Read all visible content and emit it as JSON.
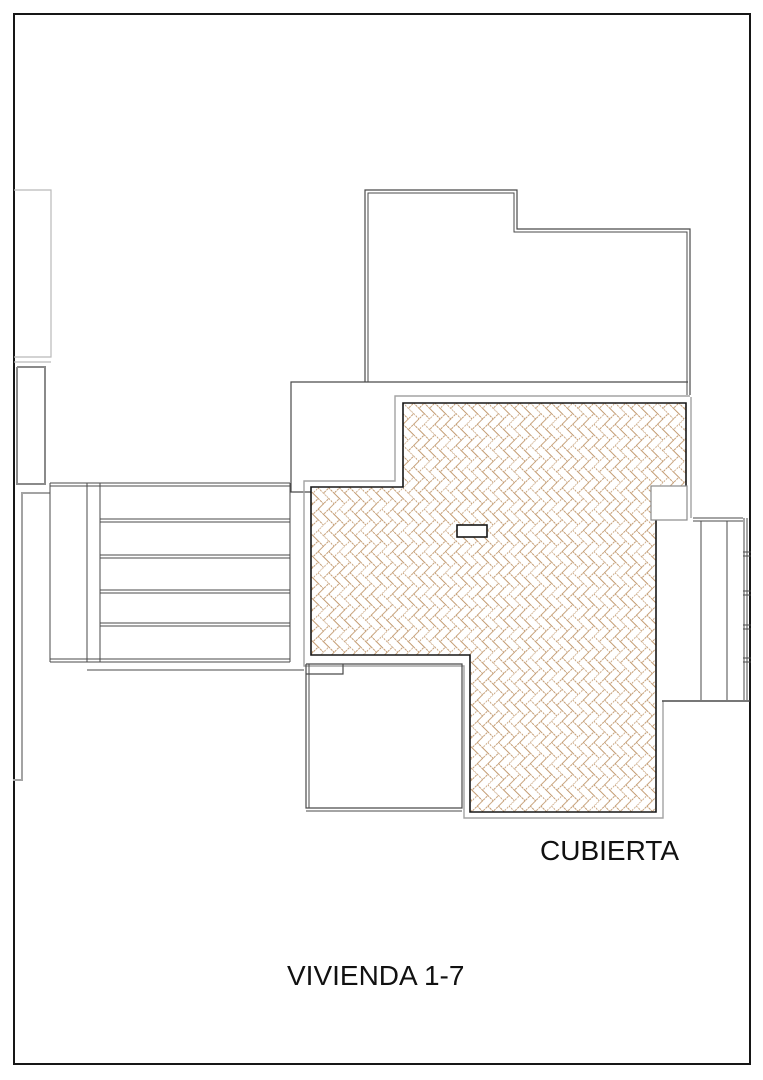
{
  "plan": {
    "labels": {
      "roof": {
        "text": "CUBIERTA",
        "x": 540,
        "y": 860,
        "size": 28
      },
      "unit": {
        "text": "VIVIENDA 1-7",
        "x": 287,
        "y": 985,
        "size": 28
      }
    },
    "colors": {
      "paper": "#ffffff",
      "black": "#161616",
      "dark": "#4a4a4a",
      "gray": "#a3a3a3",
      "lgray": "#b9b9b9",
      "mgray": "#8a8a8a",
      "hatch_stroke": "#c29a70"
    },
    "border": {
      "x": 14,
      "y": 14,
      "w": 736,
      "h": 1050
    },
    "hatch": {
      "polygon": [
        [
          403,
          403
        ],
        [
          686,
          403
        ],
        [
          686,
          518
        ],
        [
          656,
          518
        ],
        [
          656,
          812
        ],
        [
          470,
          812
        ],
        [
          470,
          655
        ],
        [
          311,
          655
        ],
        [
          311,
          487
        ],
        [
          403,
          487
        ]
      ],
      "brick_unit": 7.5,
      "angle": 45
    },
    "chimney_box": {
      "x": 651,
      "y": 486,
      "w": 36,
      "h": 34
    },
    "vent_slot": {
      "x": 457,
      "y": 525,
      "w": 30,
      "h": 12
    },
    "lines": [
      {
        "name": "left-annex-upper-outline",
        "color": "lgray",
        "width": 1.2,
        "points": [
          [
            14,
            190
          ],
          [
            51,
            190
          ],
          [
            51,
            357
          ],
          [
            14,
            357
          ]
        ]
      },
      {
        "name": "left-annex-divider",
        "color": "lgray",
        "width": 1.2,
        "points": [
          [
            14,
            362
          ],
          [
            51,
            362
          ]
        ]
      },
      {
        "name": "left-annex-lower-outline",
        "color": "mgray",
        "width": 2,
        "points": [
          [
            17,
            367
          ],
          [
            45,
            367
          ],
          [
            45,
            484
          ],
          [
            17,
            484
          ],
          [
            17,
            367
          ]
        ]
      },
      {
        "name": "handrail-line",
        "color": "gray",
        "width": 2,
        "points": [
          [
            50,
            493
          ],
          [
            22,
            493
          ],
          [
            22,
            780
          ]
        ]
      },
      {
        "name": "handrail-foot",
        "color": "gray",
        "width": 2,
        "points": [
          [
            13,
            780
          ],
          [
            23,
            780
          ]
        ]
      },
      {
        "name": "upper-building-outline-outer",
        "color": "dark",
        "width": 1.2,
        "points": [
          [
            365,
            382
          ],
          [
            365,
            190
          ],
          [
            517,
            190
          ],
          [
            517,
            229
          ],
          [
            690,
            229
          ],
          [
            690,
            395
          ]
        ]
      },
      {
        "name": "upper-building-outline-inner",
        "color": "dark",
        "width": 1,
        "points": [
          [
            368,
            382
          ],
          [
            368,
            193
          ],
          [
            514,
            193
          ],
          [
            514,
            232
          ],
          [
            687,
            232
          ],
          [
            687,
            395
          ]
        ]
      },
      {
        "name": "terrace-outline",
        "color": "dark",
        "width": 1.2,
        "points": [
          [
            688,
            382
          ],
          [
            291,
            382
          ],
          [
            291,
            492
          ],
          [
            320,
            492
          ]
        ]
      },
      {
        "name": "roof-eave-outline",
        "color": "gray",
        "width": 1.4,
        "points": [
          [
            690,
            396
          ],
          [
            395,
            396
          ],
          [
            395,
            481
          ],
          [
            304,
            481
          ],
          [
            304,
            666
          ],
          [
            464,
            666
          ],
          [
            464,
            818
          ],
          [
            663,
            818
          ],
          [
            663,
            701
          ]
        ]
      },
      {
        "name": "roof-eave-right",
        "color": "gray",
        "width": 1.4,
        "points": [
          [
            691,
            397
          ],
          [
            691,
            518
          ]
        ]
      },
      {
        "name": "stairs-top-a",
        "color": "dark",
        "width": 1,
        "points": [
          [
            50,
            483
          ],
          [
            290,
            483
          ]
        ]
      },
      {
        "name": "stairs-top-b",
        "color": "dark",
        "width": 1,
        "points": [
          [
            50,
            486
          ],
          [
            290,
            486
          ]
        ]
      },
      {
        "name": "stairs-left-wall",
        "color": "dark",
        "width": 1,
        "points": [
          [
            50,
            483
          ],
          [
            50,
            662
          ]
        ]
      },
      {
        "name": "stairs-divider-a",
        "color": "dark",
        "width": 1,
        "points": [
          [
            87,
            483
          ],
          [
            87,
            662
          ]
        ]
      },
      {
        "name": "stairs-divider-b",
        "color": "dark",
        "width": 1,
        "points": [
          [
            100,
            483
          ],
          [
            100,
            662
          ]
        ]
      },
      {
        "name": "stairs-right-wall",
        "color": "dark",
        "width": 1,
        "points": [
          [
            290,
            483
          ],
          [
            290,
            662
          ]
        ]
      },
      {
        "name": "stair-tread-1a",
        "color": "dark",
        "width": 1,
        "points": [
          [
            100,
            519
          ],
          [
            290,
            519
          ]
        ]
      },
      {
        "name": "stair-tread-1b",
        "color": "dark",
        "width": 1,
        "points": [
          [
            100,
            522
          ],
          [
            290,
            522
          ]
        ]
      },
      {
        "name": "stair-tread-2a",
        "color": "dark",
        "width": 1,
        "points": [
          [
            100,
            555
          ],
          [
            290,
            555
          ]
        ]
      },
      {
        "name": "stair-tread-2b",
        "color": "dark",
        "width": 1,
        "points": [
          [
            100,
            558
          ],
          [
            290,
            558
          ]
        ]
      },
      {
        "name": "stair-tread-3a",
        "color": "dark",
        "width": 1,
        "points": [
          [
            100,
            590
          ],
          [
            290,
            590
          ]
        ]
      },
      {
        "name": "stair-tread-3b",
        "color": "dark",
        "width": 1,
        "points": [
          [
            100,
            593
          ],
          [
            290,
            593
          ]
        ]
      },
      {
        "name": "stair-tread-4a",
        "color": "dark",
        "width": 1,
        "points": [
          [
            100,
            623
          ],
          [
            290,
            623
          ]
        ]
      },
      {
        "name": "stair-tread-4b",
        "color": "dark",
        "width": 1,
        "points": [
          [
            100,
            626
          ],
          [
            290,
            626
          ]
        ]
      },
      {
        "name": "stairs-bottom-a",
        "color": "dark",
        "width": 1,
        "points": [
          [
            50,
            659
          ],
          [
            290,
            659
          ]
        ]
      },
      {
        "name": "stairs-bottom-b",
        "color": "dark",
        "width": 1,
        "points": [
          [
            50,
            662
          ],
          [
            290,
            662
          ]
        ]
      },
      {
        "name": "stairs-under-line",
        "color": "dark",
        "width": 1,
        "points": [
          [
            87,
            670
          ],
          [
            304,
            670
          ]
        ]
      },
      {
        "name": "patio-outline",
        "color": "dark",
        "width": 1.2,
        "points": [
          [
            306,
            664
          ],
          [
            462,
            664
          ],
          [
            462,
            808
          ],
          [
            306,
            808
          ],
          [
            306,
            664
          ]
        ]
      },
      {
        "name": "patio-left-inner",
        "color": "dark",
        "width": 1,
        "points": [
          [
            309,
            664
          ],
          [
            309,
            808
          ]
        ]
      },
      {
        "name": "patio-bottom-outer",
        "color": "dark",
        "width": 1,
        "points": [
          [
            306,
            811
          ],
          [
            462,
            811
          ]
        ]
      },
      {
        "name": "patio-step-rect",
        "color": "dark",
        "width": 1.2,
        "points": [
          [
            306,
            674
          ],
          [
            343,
            674
          ],
          [
            343,
            664
          ]
        ]
      },
      {
        "name": "neighbor-top-a",
        "color": "dark",
        "width": 1,
        "points": [
          [
            693,
            518
          ],
          [
            743,
            518
          ]
        ]
      },
      {
        "name": "neighbor-top-b",
        "color": "dark",
        "width": 1,
        "points": [
          [
            693,
            521
          ],
          [
            743,
            521
          ]
        ]
      },
      {
        "name": "neighbor-divider-a",
        "color": "dark",
        "width": 1,
        "points": [
          [
            701,
            521
          ],
          [
            701,
            700
          ]
        ]
      },
      {
        "name": "neighbor-divider-b",
        "color": "dark",
        "width": 1,
        "points": [
          [
            727,
            521
          ],
          [
            727,
            700
          ]
        ]
      },
      {
        "name": "neighbor-wall-a",
        "color": "dark",
        "width": 1,
        "points": [
          [
            744,
            518
          ],
          [
            744,
            700
          ]
        ]
      },
      {
        "name": "neighbor-wall-b",
        "color": "dark",
        "width": 1,
        "points": [
          [
            747,
            518
          ],
          [
            747,
            700
          ]
        ]
      },
      {
        "name": "neighbor-tick-1a",
        "color": "dark",
        "width": 1,
        "points": [
          [
            743,
            552
          ],
          [
            751,
            552
          ]
        ]
      },
      {
        "name": "neighbor-tick-1b",
        "color": "dark",
        "width": 1,
        "points": [
          [
            743,
            556
          ],
          [
            751,
            556
          ]
        ]
      },
      {
        "name": "neighbor-tick-2a",
        "color": "dark",
        "width": 1,
        "points": [
          [
            743,
            591
          ],
          [
            751,
            591
          ]
        ]
      },
      {
        "name": "neighbor-tick-2b",
        "color": "dark",
        "width": 1,
        "points": [
          [
            743,
            595
          ],
          [
            751,
            595
          ]
        ]
      },
      {
        "name": "neighbor-tick-3a",
        "color": "dark",
        "width": 1,
        "points": [
          [
            743,
            625
          ],
          [
            751,
            625
          ]
        ]
      },
      {
        "name": "neighbor-tick-3b",
        "color": "dark",
        "width": 1,
        "points": [
          [
            743,
            629
          ],
          [
            751,
            629
          ]
        ]
      },
      {
        "name": "neighbor-tick-4a",
        "color": "dark",
        "width": 1,
        "points": [
          [
            743,
            658
          ],
          [
            751,
            658
          ]
        ]
      },
      {
        "name": "neighbor-tick-4b",
        "color": "dark",
        "width": 1,
        "points": [
          [
            743,
            662
          ],
          [
            751,
            662
          ]
        ]
      },
      {
        "name": "neighbor-bottom",
        "color": "dark",
        "width": 1.4,
        "points": [
          [
            662,
            701
          ],
          [
            750,
            701
          ]
        ]
      }
    ]
  }
}
